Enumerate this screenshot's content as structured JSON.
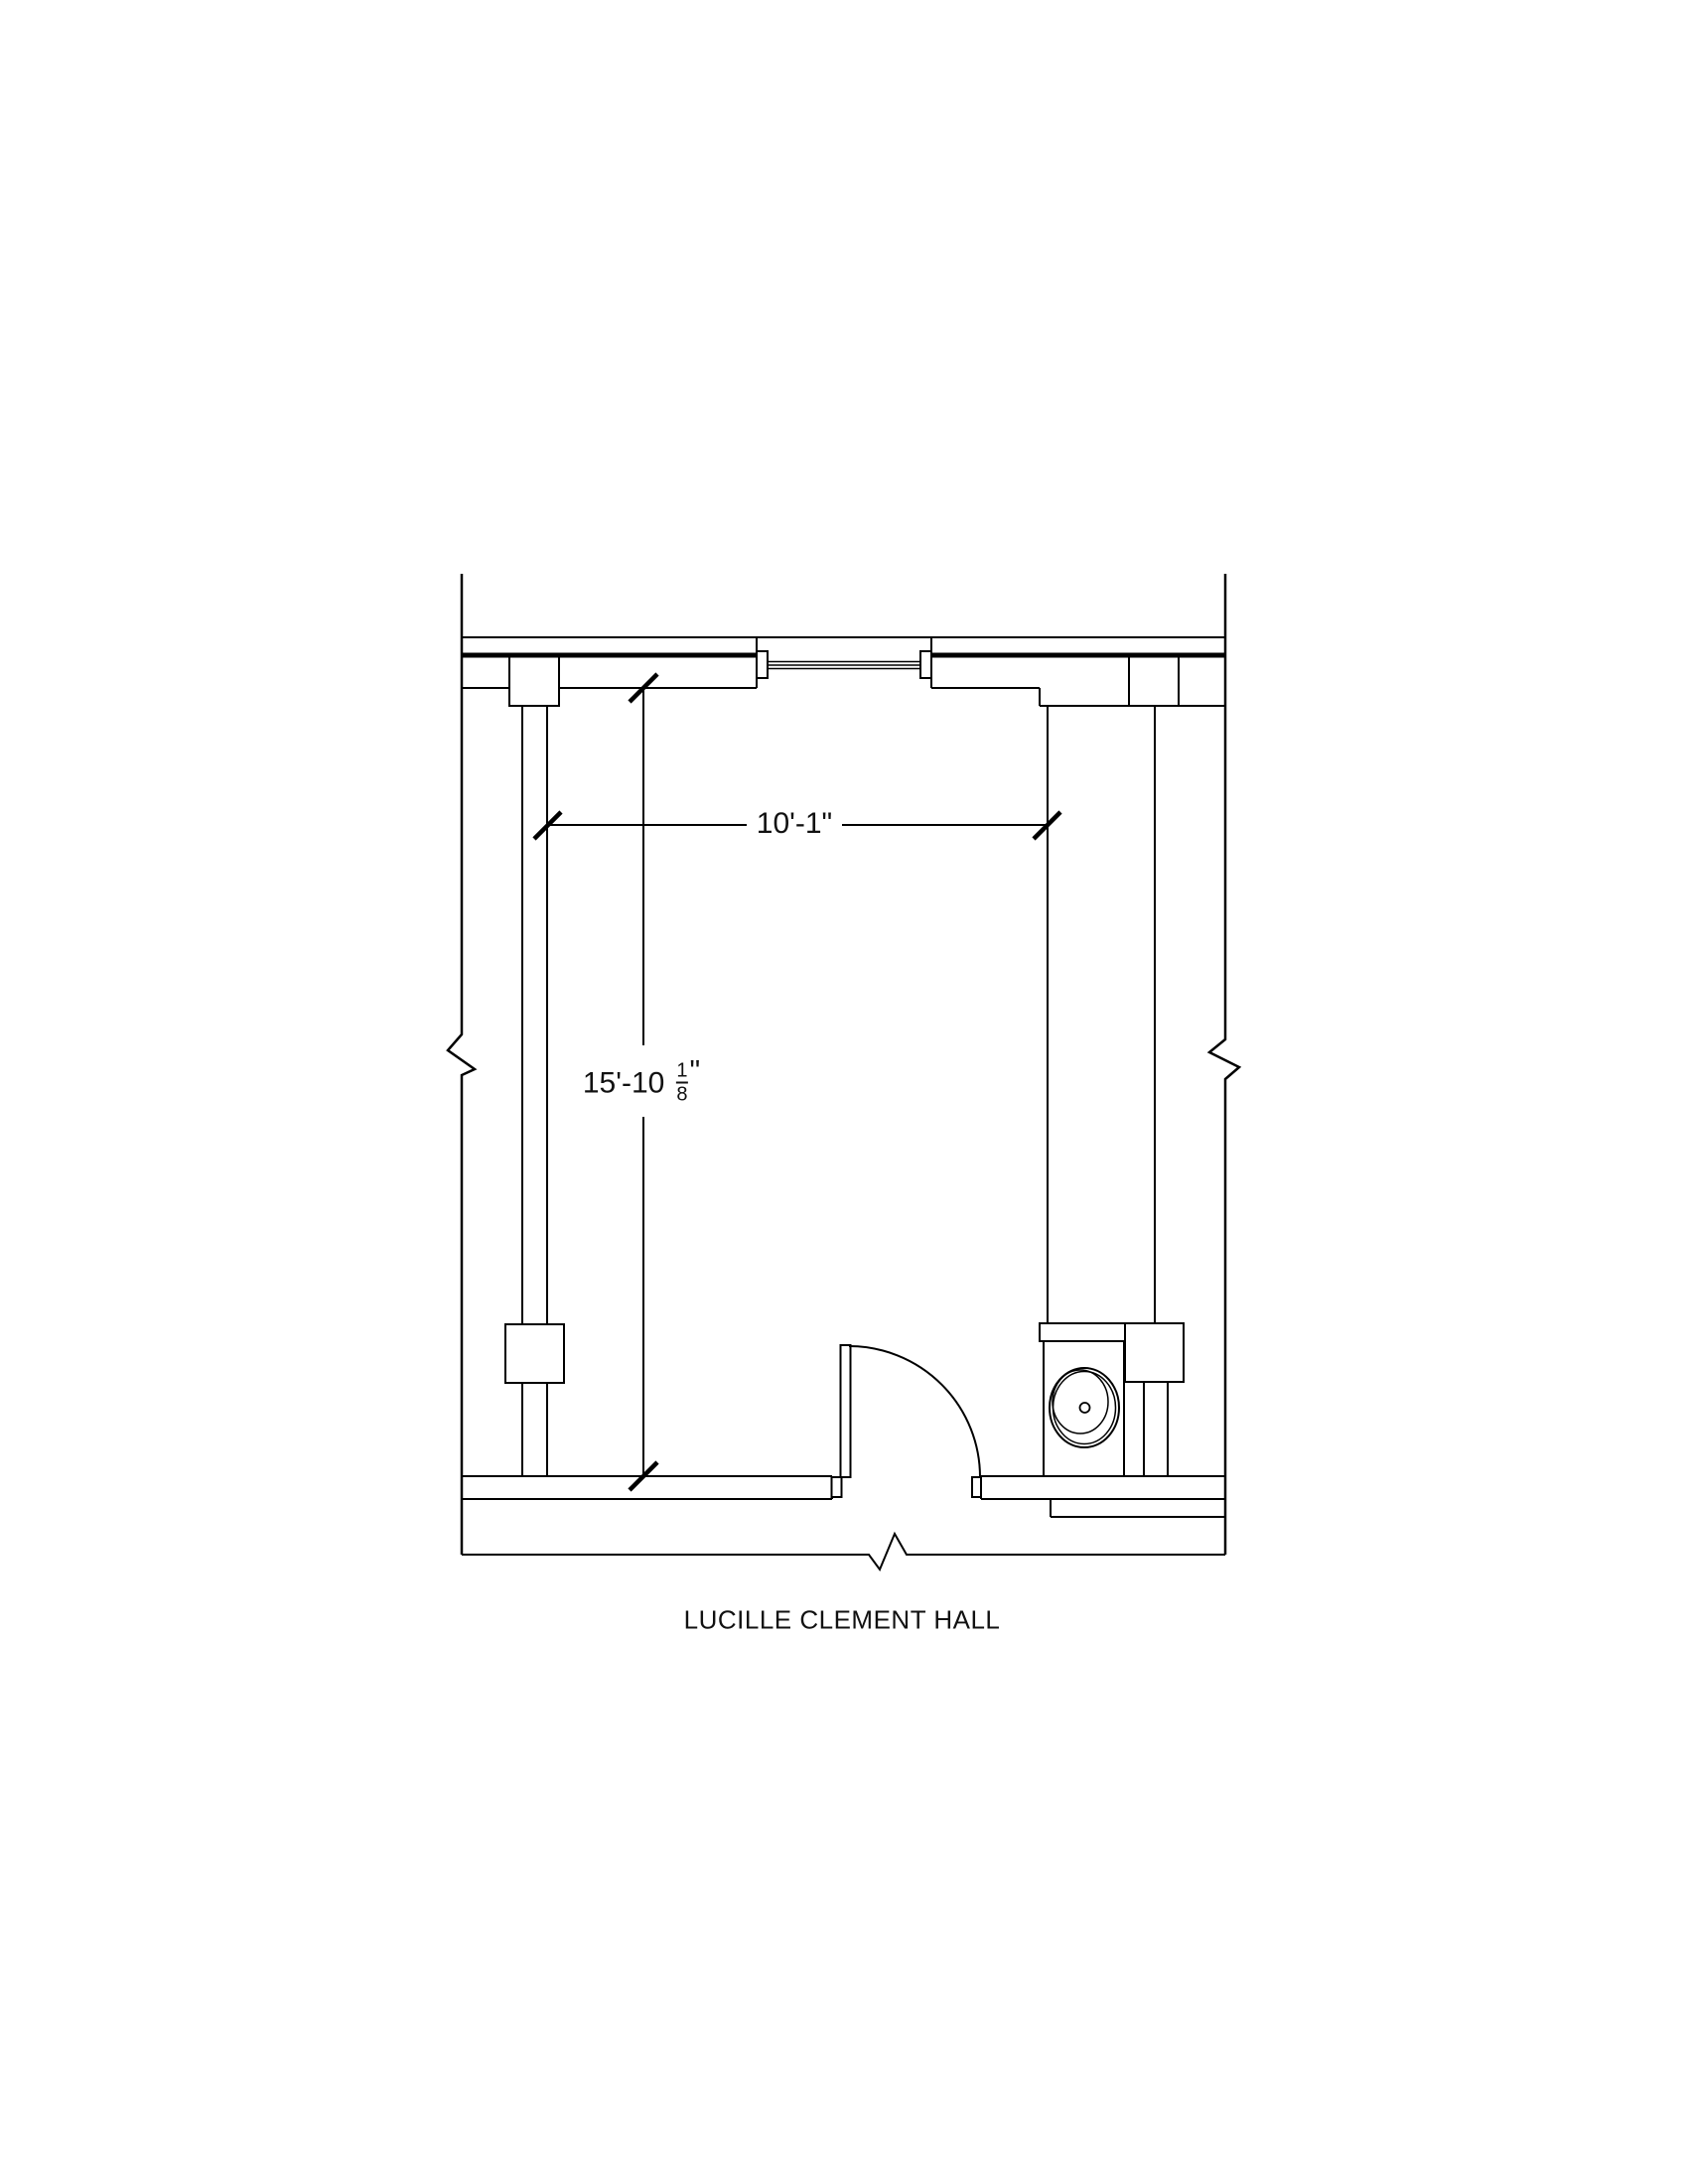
{
  "title": "LUCILLE CLEMENT HALL",
  "dimensions": {
    "width": {
      "label": "10'-1\""
    },
    "height": {
      "whole": "15'-10",
      "fraction_numerator": "1",
      "fraction_denominator": "8",
      "unit_suffix": "\""
    }
  },
  "colors": {
    "line": "#000000",
    "text": "#111111",
    "background": "#ffffff"
  }
}
